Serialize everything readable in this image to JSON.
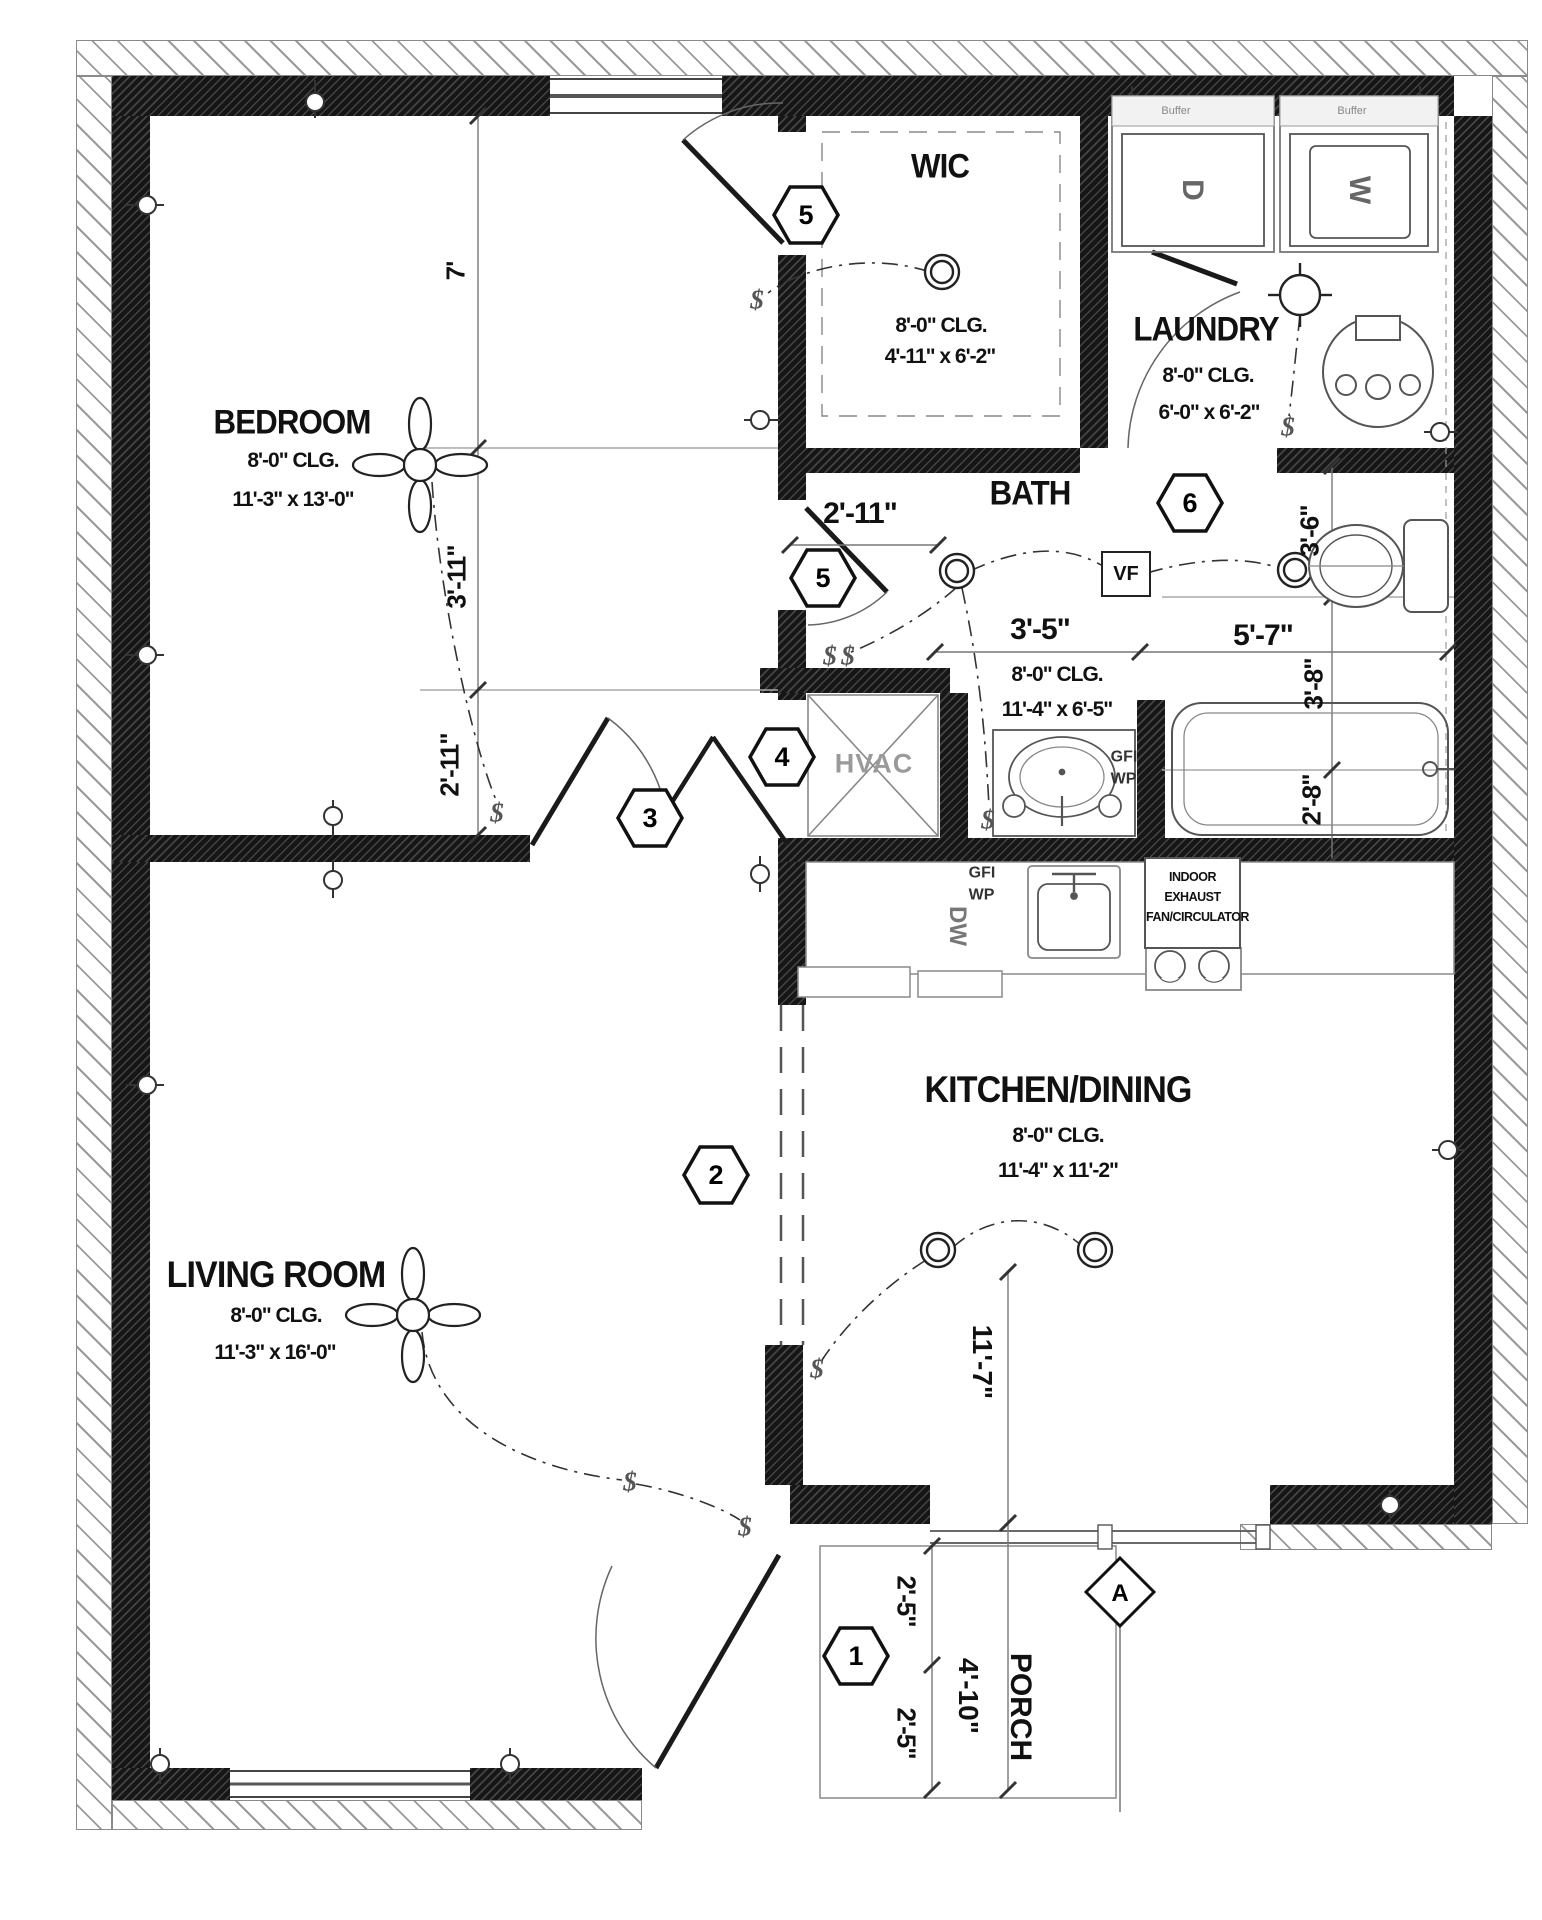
{
  "plan": {
    "rooms": {
      "bedroom": {
        "name": "BEDROOM",
        "ceiling": "8'-0\" CLG.",
        "size": "11'-3\" x 13'-0\""
      },
      "wic": {
        "name": "WIC",
        "ceiling": "8'-0\" CLG.",
        "size": "4'-11\" x 6'-2\""
      },
      "laundry": {
        "name": "LAUNDRY",
        "ceiling": "8'-0\" CLG.",
        "size": "6'-0\" x 6'-2\""
      },
      "bath": {
        "name": "BATH",
        "ceiling": "8'-0\" CLG.",
        "size": "11'-4\" x 6'-5\""
      },
      "kitchen": {
        "name": "KITCHEN/DINING",
        "ceiling": "8'-0\" CLG.",
        "size": "11'-4\" x 11'-2\""
      },
      "living": {
        "name": "LIVING ROOM",
        "ceiling": "8'-0\" CLG.",
        "size": "11'-3\" x 16'-0\""
      },
      "porch": {
        "name": "PORCH"
      },
      "hvac": {
        "name": "HVAC"
      }
    },
    "dims": {
      "bed_v1": "7'",
      "bed_v2": "3'-11\"",
      "bed_v3": "2'-11\"",
      "bath_door": "2'-11\"",
      "bath_w1": "3'-5\"",
      "bath_w2": "5'-7\"",
      "right_v1": "3'-6\"",
      "right_v2": "3'-8\"",
      "right_v3": "2'-8\"",
      "kitchen_v": "11'-7\"",
      "porch_v1": "2'-5\"",
      "porch_v2": "2'-5\"",
      "porch_w": "4'-10\""
    },
    "tags": {
      "entry": "1",
      "opening": "2",
      "bedroom_door": "3",
      "hvac_door": "4",
      "wic_door": "5",
      "hall_door": "5",
      "laundry_door": "6",
      "detail": "A"
    },
    "labels": {
      "vf": "VF",
      "dw": "DW",
      "gfi": "GFI",
      "wp": "WP",
      "buffer": "Buffer",
      "dryer": "D",
      "washer": "W",
      "exhaust_line1": "INDOOR EXHAUST",
      "exhaust_line2": "FAN/CIRCULATOR"
    },
    "symbols": {
      "switch": "$"
    }
  }
}
